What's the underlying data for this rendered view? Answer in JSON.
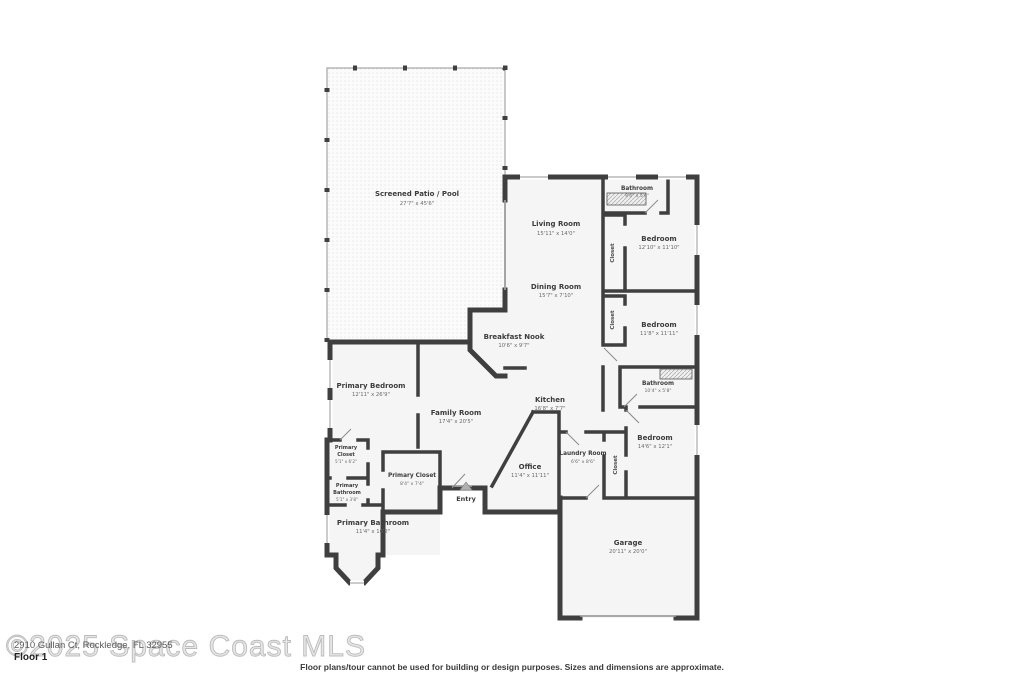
{
  "floorplan": {
    "rooms": [
      {
        "name": "Screened Patio / Pool",
        "dims": "27'7\" x 45'6\""
      },
      {
        "name": "Living Room",
        "dims": "15'11\" x 14'0\""
      },
      {
        "name": "Bathroom",
        "dims": "9'4\" x 5'6\""
      },
      {
        "name": "Bedroom",
        "dims": "12'10\" x 11'10\""
      },
      {
        "name": "Dining Room",
        "dims": "15'7\" x 7'10\""
      },
      {
        "name": "Bedroom",
        "dims": "11'8\" x 11'11\""
      },
      {
        "name": "Breakfast Nook",
        "dims": "10'6\" x 9'7\""
      },
      {
        "name": "Bathroom",
        "dims": "10'4\" x 5'8\""
      },
      {
        "name": "Kitchen",
        "dims": "16'8\" x 7'7\""
      },
      {
        "name": "Primary Bedroom",
        "dims": "12'11\" x 26'9\""
      },
      {
        "name": "Family Room",
        "dims": "17'4\" x 20'5\""
      },
      {
        "name": "Bedroom",
        "dims": "14'6\" x 12'1\""
      },
      {
        "name": "Laundry Room",
        "dims": "6'6\" x 8'6\""
      },
      {
        "name_line1": "Primary",
        "name_line2": "Closet",
        "dims": "5'1\" x 6'2\""
      },
      {
        "name_line1": "Primary",
        "name_line2": "Bathroom",
        "dims": "5'1\" x 3'8\""
      },
      {
        "name": "Primary Closet",
        "dims": "8'4\" x 7'4\""
      },
      {
        "name": "Office",
        "dims": "11'4\" x 11'11\""
      },
      {
        "name": "Primary Bathroom",
        "dims": "11'4\" x 16'2\""
      },
      {
        "name": "Garage",
        "dims": "20'11\" x 20'0\""
      }
    ],
    "closet_label": "Closet",
    "entry_label": "Entry"
  },
  "footer": {
    "watermark": "©2025 Space Coast MLS",
    "address": "2910 Gullan Ct, Rockledge, FL 32955",
    "floor_label": "Floor 1",
    "disclaimer": "Floor plans/tour cannot be used for building or design purposes. Sizes and dimensions are approximate."
  },
  "colors": {
    "wall": "#3f3f3f",
    "room_fill": "#f5f5f5",
    "watermark_gray": "#bcbcbc"
  }
}
